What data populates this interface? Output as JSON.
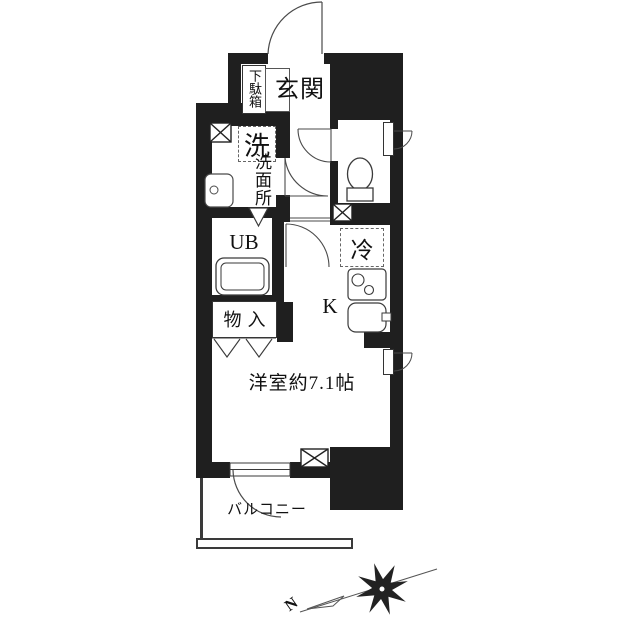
{
  "floorplan": {
    "rooms": {
      "entrance": "玄関",
      "shoe_cabinet": "下駄箱",
      "laundry": "洗",
      "washroom": "洗面所",
      "unit_bath": "UB",
      "storage": "物入",
      "refrigerator": "冷",
      "kitchen": "K",
      "western_room": "洋室約7.1帖",
      "balcony": "バルコニー"
    },
    "compass": {
      "north_label": "N"
    },
    "colors": {
      "wall": "#1f1f1f",
      "line": "#3a3a3a",
      "background": "#ffffff"
    }
  }
}
